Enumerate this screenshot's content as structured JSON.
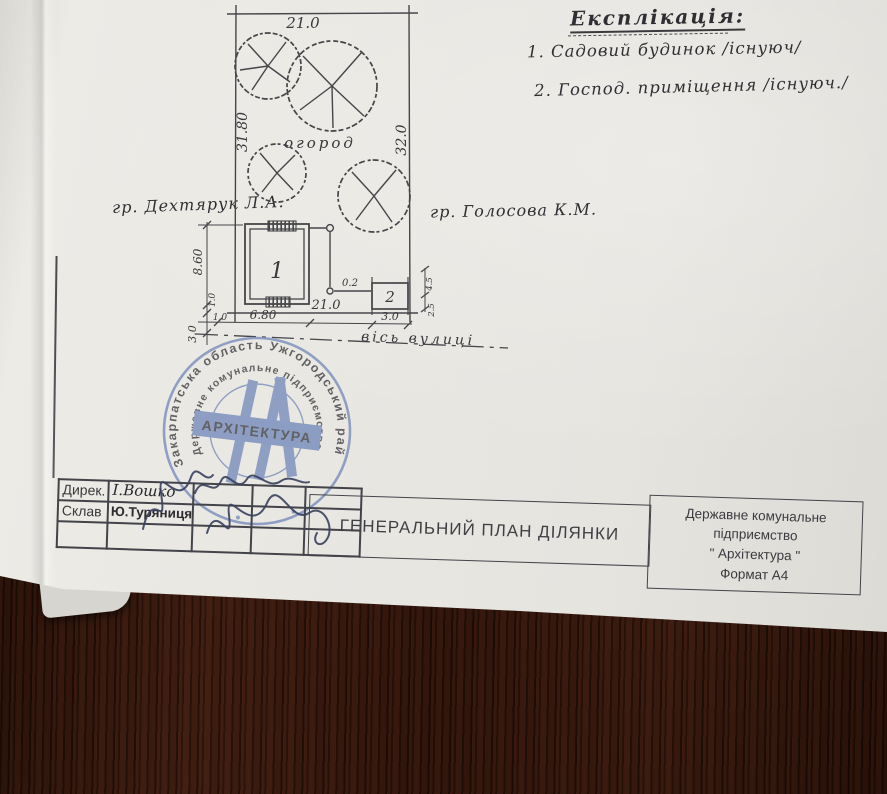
{
  "explication": {
    "title": "Експлікація:",
    "items": [
      {
        "text": "1. Садовий будинок /існуюч/"
      },
      {
        "text": "2. Господ. приміщення /існуюч./"
      }
    ]
  },
  "plan": {
    "garden_label": "огород",
    "street_axis_label": "вісь вулиці",
    "neighbor_left": "гр. Дехтярук Л.А.",
    "neighbor_right": "гр. Голосова К.М.",
    "buildings": [
      {
        "number": "1"
      },
      {
        "number": "2"
      }
    ],
    "dimensions": {
      "top_width": "21.0",
      "left_depth": "31.80",
      "right_depth": "32.0",
      "bottom_width": "21.0",
      "house_front": "6.80",
      "house_depth": "8.60",
      "shed_front": "3.0",
      "street_setback": "3.0",
      "side_gap": "1.0",
      "fence_gap": "0.2",
      "shed_side_a": "4.5",
      "shed_side_b": "2.5"
    }
  },
  "stamp": {
    "ring_outer": "Закарпатська область Ужгородський район",
    "ring_inner": "Державне комунальне підприємство",
    "center": "АРХІТЕКТУРА"
  },
  "title_block": {
    "rows": [
      {
        "label": "Дирек.",
        "name": "І.Вошко"
      },
      {
        "label": "Склав",
        "name": "Ю.Туряниця"
      }
    ],
    "title": "ГЕНЕРАЛЬНИЙ ПЛАН ДІЛЯНКИ",
    "org_lines": [
      "Державне комунальне",
      "підприємство",
      "\" Архітектура \"",
      "Формат А4"
    ]
  }
}
